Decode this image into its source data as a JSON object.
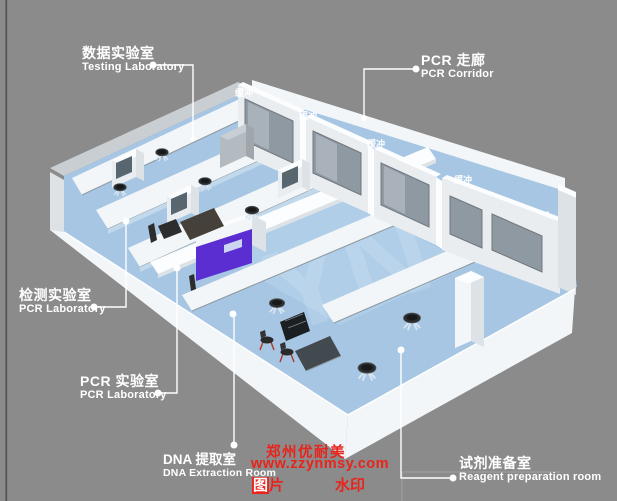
{
  "scene": {
    "bg": "#8b8b8b",
    "floor": "#a6c6e4",
    "wall": "#f3f6f8",
    "window": "#8f99a2",
    "purple": "#5b2ed1",
    "label": "#ffffff",
    "red": "#e8241c"
  },
  "labels": {
    "testing": {
      "zh": "数据实验室",
      "en": "Testing Laboratory"
    },
    "corridor": {
      "zh": "PCR 走廊",
      "en": "PCR Corridor"
    },
    "detection": {
      "zh": "检测实验室",
      "en": "PCR Laboratory"
    },
    "pcr": {
      "zh": "PCR 实验室",
      "en": "PCR Laboratory"
    },
    "dna": {
      "zh": "DNA 提取室",
      "en": "DNA Extraction Room"
    },
    "reagent": {
      "zh": "试剂准备室",
      "en": "Reagent preparation room"
    }
  },
  "buffer_labels": {
    "b1": "缓冲",
    "b2": "缓冲",
    "b3": "缓冲",
    "b4": "缓冲"
  },
  "watermark": {
    "brand": "郑州优耐美",
    "url": "www.zzynmsy.com",
    "tag_left_boxed": "图",
    "tag_left_rest": "片",
    "tag_right": "水印",
    "monogram": "YN"
  }
}
